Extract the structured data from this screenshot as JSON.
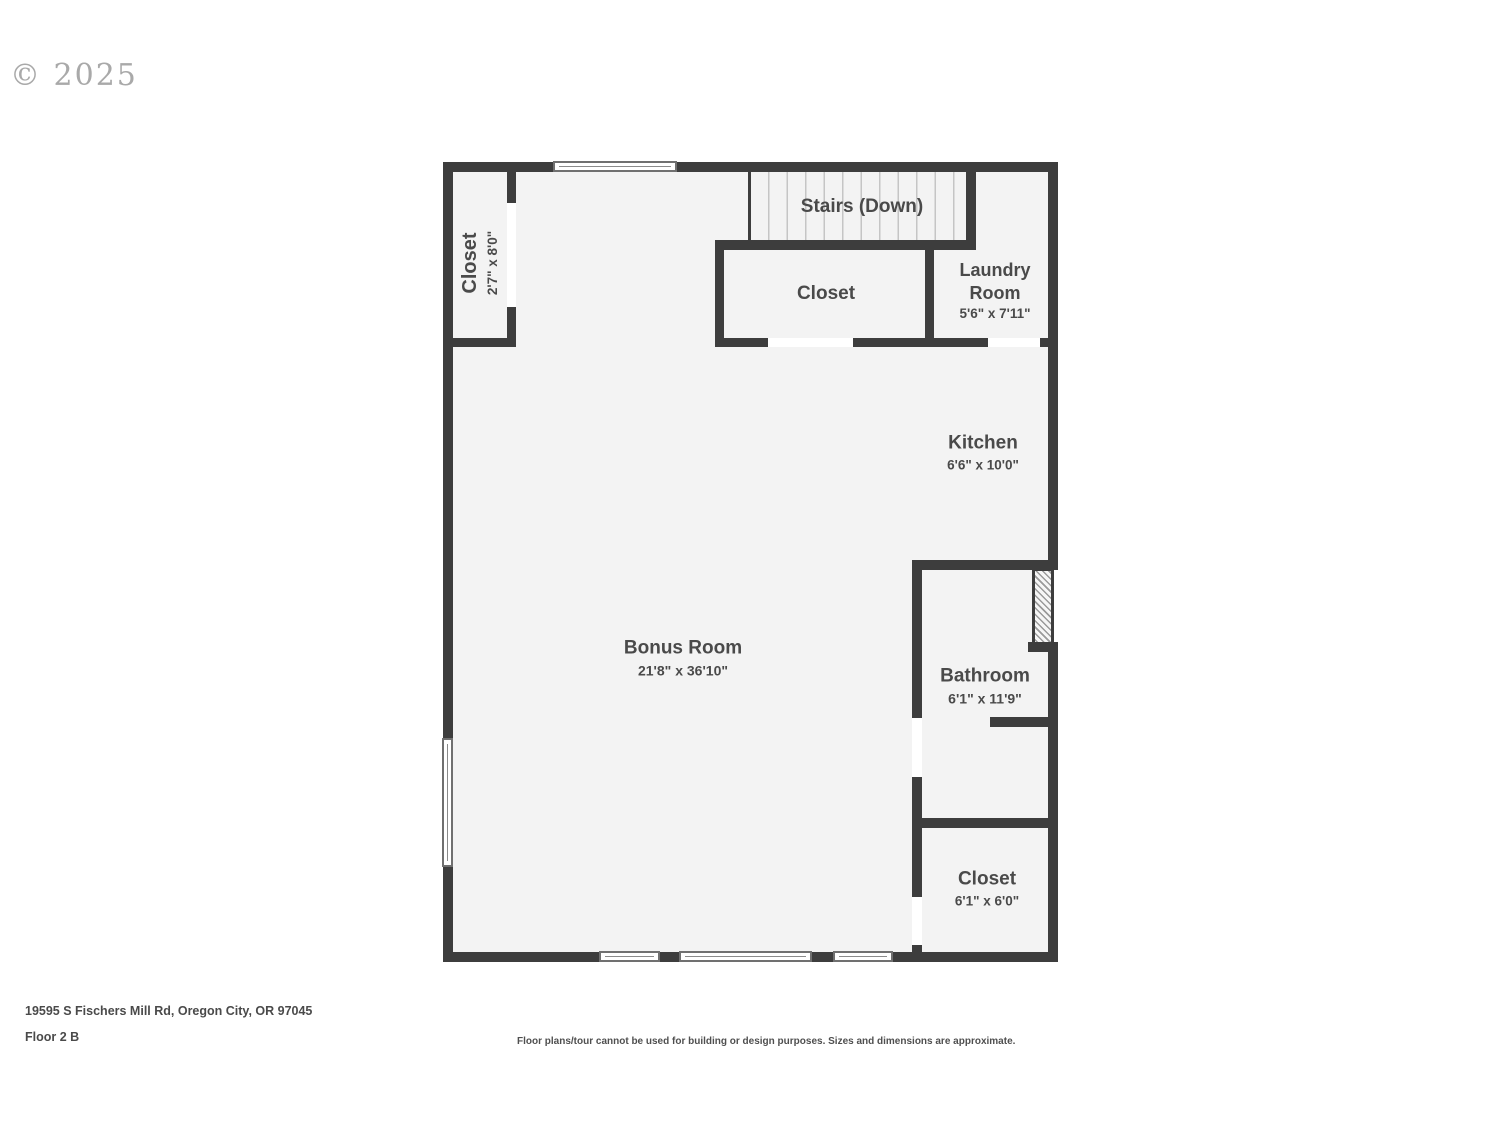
{
  "watermark": "© 2025",
  "plan": {
    "rooms": {
      "closet_top_left": {
        "name": "Closet",
        "dims": "2'7\" x 8'0\""
      },
      "stairs": {
        "name": "Stairs (Down)"
      },
      "closet_middle": {
        "name": "Closet"
      },
      "laundry": {
        "name": "Laundry Room",
        "dims": "5'6\" x 7'11\""
      },
      "kitchen": {
        "name": "Kitchen",
        "dims": "6'6\" x 10'0\""
      },
      "bonus_room": {
        "name": "Bonus Room",
        "dims": "21'8\" x 36'10\""
      },
      "bathroom": {
        "name": "Bathroom",
        "dims": "6'1\" x 11'9\""
      },
      "closet_bottom_right": {
        "name": "Closet",
        "dims": "6'1\" x 6'0\""
      }
    }
  },
  "footer": {
    "address": "19595 S Fischers Mill Rd, Oregon City, OR 97045",
    "floor_label": "Floor 2 B",
    "disclaimer": "Floor plans/tour cannot be used for building or design purposes. Sizes and dimensions are approximate."
  },
  "colors": {
    "wall": "#3d3d3d",
    "floor": "#f3f3f3",
    "label": "#4a4a4a"
  }
}
